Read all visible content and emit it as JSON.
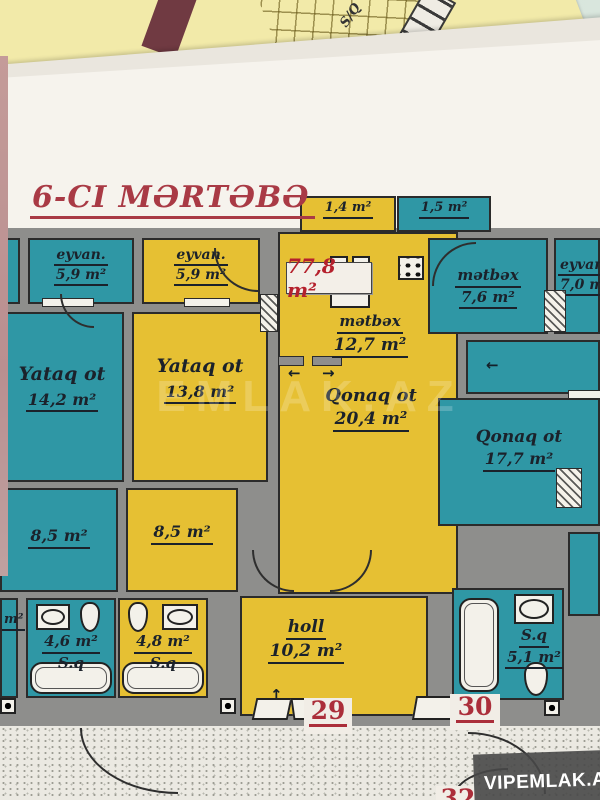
{
  "title": "6-CI MƏRTƏBƏ",
  "total_area_badge": "77,8 m²",
  "rooms": {
    "eyvan_left": {
      "name": "eyvan.",
      "area": "5,9 m²"
    },
    "eyvan_mid": {
      "name": "eyvan.",
      "area": "5,9 m²"
    },
    "small_yellow": {
      "area": "1,4 m²"
    },
    "small_teal": {
      "area": "1,5 m²"
    },
    "metbex_mid": {
      "name": "mətbəx",
      "area": "12,7 m²"
    },
    "qonaq_mid": {
      "name": "Qonaq ot",
      "area": "20,4 m²"
    },
    "yataq_left": {
      "name": "Yataq ot",
      "area": "14,2 m²"
    },
    "yataq_mid": {
      "name": "Yataq ot",
      "area": "13,8 m²"
    },
    "metbex_right": {
      "name": "mətbəx",
      "area": "7,6 m²"
    },
    "eyvan_right": {
      "name": "eyvan.",
      "area": "7,0 m²"
    },
    "qonaq_right": {
      "name": "Qonaq ot",
      "area": "17,7 m²"
    },
    "small_left": {
      "area": "8,5 m²"
    },
    "small_mid": {
      "area": "8,5 m²"
    },
    "bath_left": {
      "area": "4,6 m²",
      "name": "S.q"
    },
    "bath_mid": {
      "area": "4,8 m²",
      "name": "S.q"
    },
    "bath_right": {
      "name": "S.q",
      "area": "5,1 m²"
    },
    "holl": {
      "name": "holl",
      "area": "10,2 m²"
    },
    "edge_fragment": {
      "area": "m²"
    }
  },
  "units": {
    "left": "29",
    "right": "30",
    "bottom": "32"
  },
  "symbols": {
    "arrow_left": "←",
    "arrow_right": "→",
    "arrow_up": "↑",
    "sq_rotated": "S/Q"
  },
  "watermarks": {
    "brand": "VIPEMLAK.AZ",
    "ghost": "EMLAK.AZ"
  },
  "colors": {
    "teal": "#2f97a5",
    "yellow": "#e6c033",
    "wall_gray": "#8e8e8c",
    "title_red": "#a93a45",
    "number_red": "#ab2e3a",
    "maroon": "#703a42",
    "mint": "#ccdcd2",
    "sheet": "#f6f3ed"
  }
}
